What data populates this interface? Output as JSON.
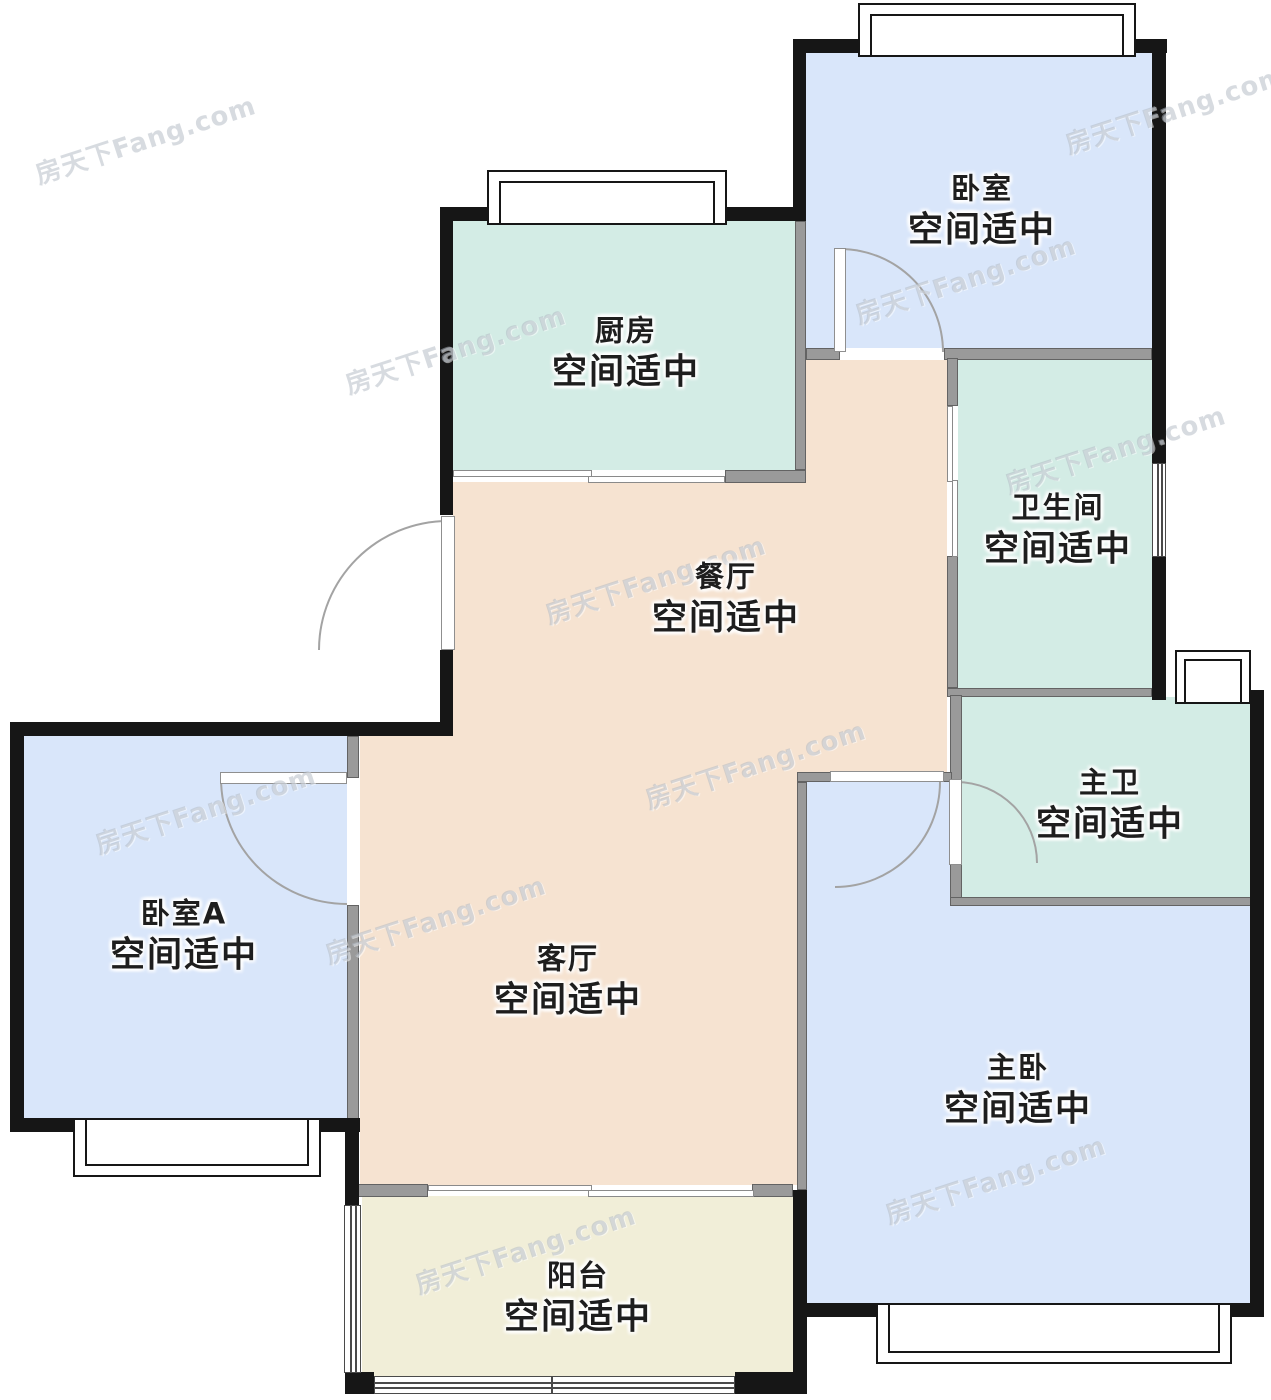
{
  "watermark": {
    "text": "房天下Fang.com"
  },
  "rooms": [
    {
      "id": "bedroom-north",
      "label": "卧室",
      "status": "空间适中",
      "fill": "#d9e6fa"
    },
    {
      "id": "kitchen",
      "label": "厨房",
      "status": "空间适中",
      "fill": "#d3ece5"
    },
    {
      "id": "bathroom",
      "label": "卫生间",
      "status": "空间适中",
      "fill": "#d3ece5"
    },
    {
      "id": "dining",
      "label": "餐厅",
      "status": "空间适中",
      "fill": "#f6e3d1"
    },
    {
      "id": "master-bath",
      "label": "主卫",
      "status": "空间适中",
      "fill": "#d3ece5"
    },
    {
      "id": "bedroom-a",
      "label": "卧室A",
      "status": "空间适中",
      "fill": "#d9e6fa"
    },
    {
      "id": "living",
      "label": "客厅",
      "status": "空间适中",
      "fill": "#f6e3d1"
    },
    {
      "id": "master-bedroom",
      "label": "主卧",
      "status": "空间适中",
      "fill": "#d9e6fa"
    },
    {
      "id": "balcony",
      "label": "阳台",
      "status": "空间适中",
      "fill": "#f1eed8"
    }
  ],
  "palette": {
    "wall_exterior": "#161616",
    "wall_interior": "#9a9a9a",
    "bedroom_fill": "#d9e6fa",
    "wet_area_fill": "#d3ece5",
    "living_fill": "#f6e3d1",
    "balcony_fill": "#f1eed8",
    "label_color": "#1e1e1e",
    "watermark_color": "#b0b8c1"
  }
}
